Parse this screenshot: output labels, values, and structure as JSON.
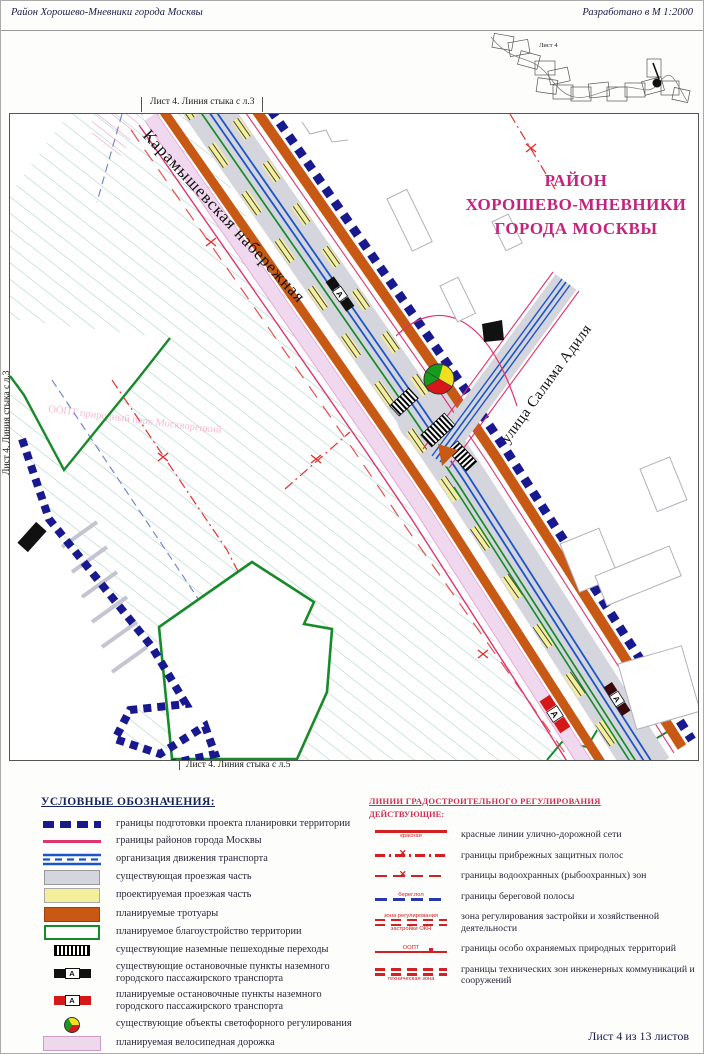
{
  "header": {
    "left": "Район Хорошево-Мневники города Москвы",
    "right": "Разработано в М 1:2000"
  },
  "index_map": {
    "label": "Лист 4"
  },
  "map": {
    "edge_top": "Лист 4. Линия стыка с л.3",
    "edge_left": "Лист 4. Линия стыка с л.3",
    "edge_bottom": "Лист 4. Линия стыка с л.5",
    "title_line1": "РАЙОН",
    "title_line2": "ХОРОШЕВО-МНЕВНИКИ",
    "title_line3": "ГОРОДА МОСКВЫ",
    "street_1": "Карамышевская набережная",
    "street_2": "улица Салима Адиля",
    "oopt_label": "ООПТ природный парк Москворецкий",
    "bus_stop_letter": "А"
  },
  "legend": {
    "title": "УСЛОВНЫЕ ОБОЗНАЧЕНИЯ:",
    "items": [
      {
        "label": "границы подготовки проекта планировки территории"
      },
      {
        "label": "границы районов города Москвы"
      },
      {
        "label": "организация движения транспорта"
      },
      {
        "label": "существующая проезжая часть"
      },
      {
        "label": "проектируемая проезжая часть"
      },
      {
        "label": "планируемые тротуары"
      },
      {
        "label": "планируемое благоустройство территории"
      },
      {
        "label": "существующие наземные пешеходные переходы"
      },
      {
        "label": "существующие остановочные пункты наземного городского пассажирского транспорта"
      },
      {
        "label": "планируемые остановочные пункты наземного городского пассажирского транспорта"
      },
      {
        "label": "существующие объекты светофорного регулирования"
      },
      {
        "label": "планируемая велосипедная дорожка"
      }
    ]
  },
  "regulation": {
    "title": "ЛИНИИ ГРАДОСТРОИТЕЛЬНОГО РЕГУЛИРОВАНИЯ",
    "subtitle": "ДЕЙСТВУЮЩИЕ:",
    "items": [
      {
        "ann": "красная",
        "label": "красные линии улично-дорожной сети"
      },
      {
        "label": "границы прибрежных защитных полос"
      },
      {
        "label": "границы водоохранных (рыбоохранных) зон"
      },
      {
        "ann": "берег.пол",
        "label": "границы береговой полосы"
      },
      {
        "ann_top": "зона регулирования",
        "ann_bottom": "застройки ОКН",
        "label": "зона регулирования застройки и хозяйственной деятельности"
      },
      {
        "ann": "ООПТ",
        "label": "границы особо охраняемых природных территорий"
      },
      {
        "ann": "техническая зона",
        "label": "границы технических зон инженерных коммуникаций и сооружений"
      }
    ]
  },
  "footer": {
    "sheet": "Лист 4 из 13 листов"
  },
  "colors": {
    "boundary_navy": "#18188f",
    "district_red": "#e0336e",
    "roadway_gray": "#d5d5de",
    "planned_yellow": "#f4ef9a",
    "sidewalk_orange": "#c75914",
    "landscaping_green": "#178a2a",
    "bike_pink": "#f0d8ee",
    "regulation_red": "#d42020",
    "title_magenta": "#c2247e"
  }
}
